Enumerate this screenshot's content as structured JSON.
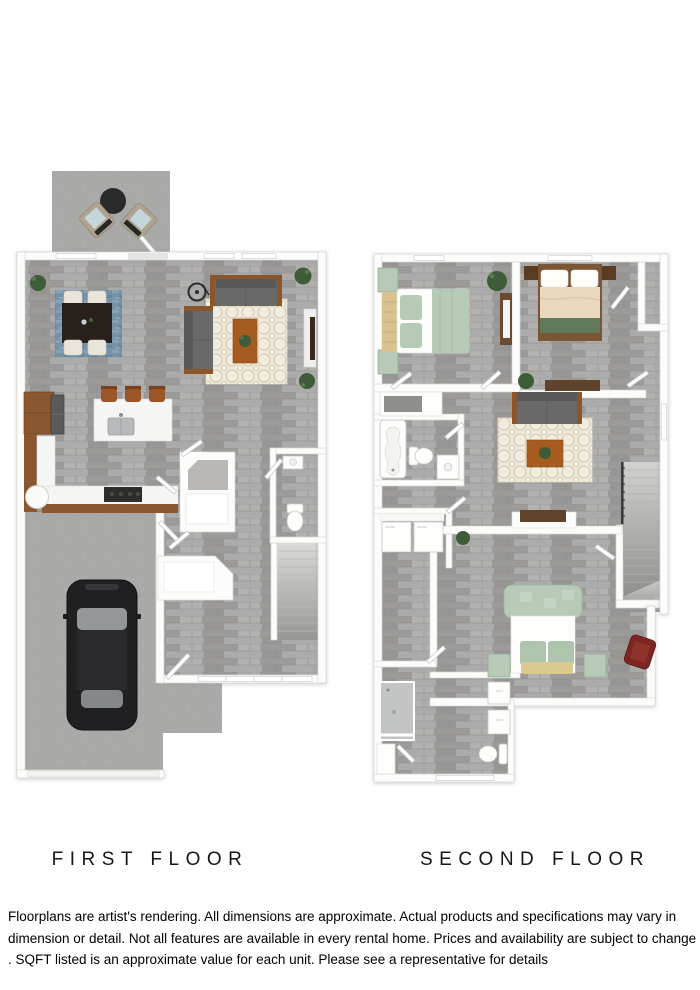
{
  "plans": {
    "first": {
      "label": "FIRST FLOOR",
      "areas": [
        "patio",
        "living-room",
        "dining-area",
        "kitchen",
        "pantry",
        "powder-room",
        "stairs",
        "foyer",
        "garage",
        "stoop"
      ],
      "furniture_icons": [
        "patio-table-icon",
        "patio-chair-icon",
        "dining-table-icon",
        "dining-chair-icon",
        "blue-rug-icon",
        "sofa-icon",
        "loveseat-icon",
        "floor-lamp-icon",
        "trellis-rug-icon",
        "coffee-table-icon",
        "tv-console-icon",
        "kitchen-island-icon",
        "bar-stool-icon",
        "sink-icon",
        "refrigerator-icon",
        "range-icon",
        "water-heater-icon",
        "toilet-icon",
        "vanity-icon",
        "car-icon",
        "plant-icon"
      ]
    },
    "second": {
      "label": "SECOND FLOOR",
      "areas": [
        "bedroom-2",
        "bedroom-3",
        "walk-in-closet",
        "loft",
        "hall-bath",
        "laundry",
        "primary-closet",
        "primary-bedroom",
        "primary-bath",
        "stairs"
      ],
      "furniture_icons": [
        "bed-icon",
        "nightstand-icon",
        "dresser-icon",
        "sofa-icon",
        "trellis-rug-icon",
        "coffee-table-icon",
        "desk-icon",
        "bathtub-icon",
        "toilet-icon",
        "vanity-icon",
        "washer-icon",
        "dryer-icon",
        "shower-icon",
        "ottoman-icon",
        "accent-chair-icon",
        "plant-icon"
      ]
    }
  },
  "disclaimer": {
    "lines": [
      "Floorplans are artist's rendering. All dimensions are approximate. Actual products and specifications may vary in",
      "dimension or detail. Not all features are available in every rental home. Prices and availability are subject to change",
      ". SQFT listed is an approximate value for each unit. Please see a representative for details"
    ]
  },
  "colors": {
    "wall": "#fcfcfb",
    "wallEdge": "#d8d7d5",
    "woodBase": "#a3a2a0",
    "concrete": "#a9a9a7",
    "rugBlue": "#7492a8",
    "rugCream": "#f1ecdf",
    "rugCreamLine": "#cfc5ab",
    "marble": "#f5f5f3",
    "cabinetBrown": "#8a5731",
    "woodFurniture": "#a65c20",
    "sofaGray": "#696969",
    "sofaDark": "#585858",
    "chairCream": "#e9e5da",
    "tableDark": "#27201b",
    "bedGreen": "#b7cab6",
    "bedGreenDark": "#5e7a59",
    "bedCream": "#ead9bd",
    "headboardTan": "#d8c28f",
    "chairRed": "#7c2621",
    "carBlack": "#202023",
    "glassGray": "#95989b",
    "plantGreen": "#3e5c38",
    "label": "#161616"
  }
}
